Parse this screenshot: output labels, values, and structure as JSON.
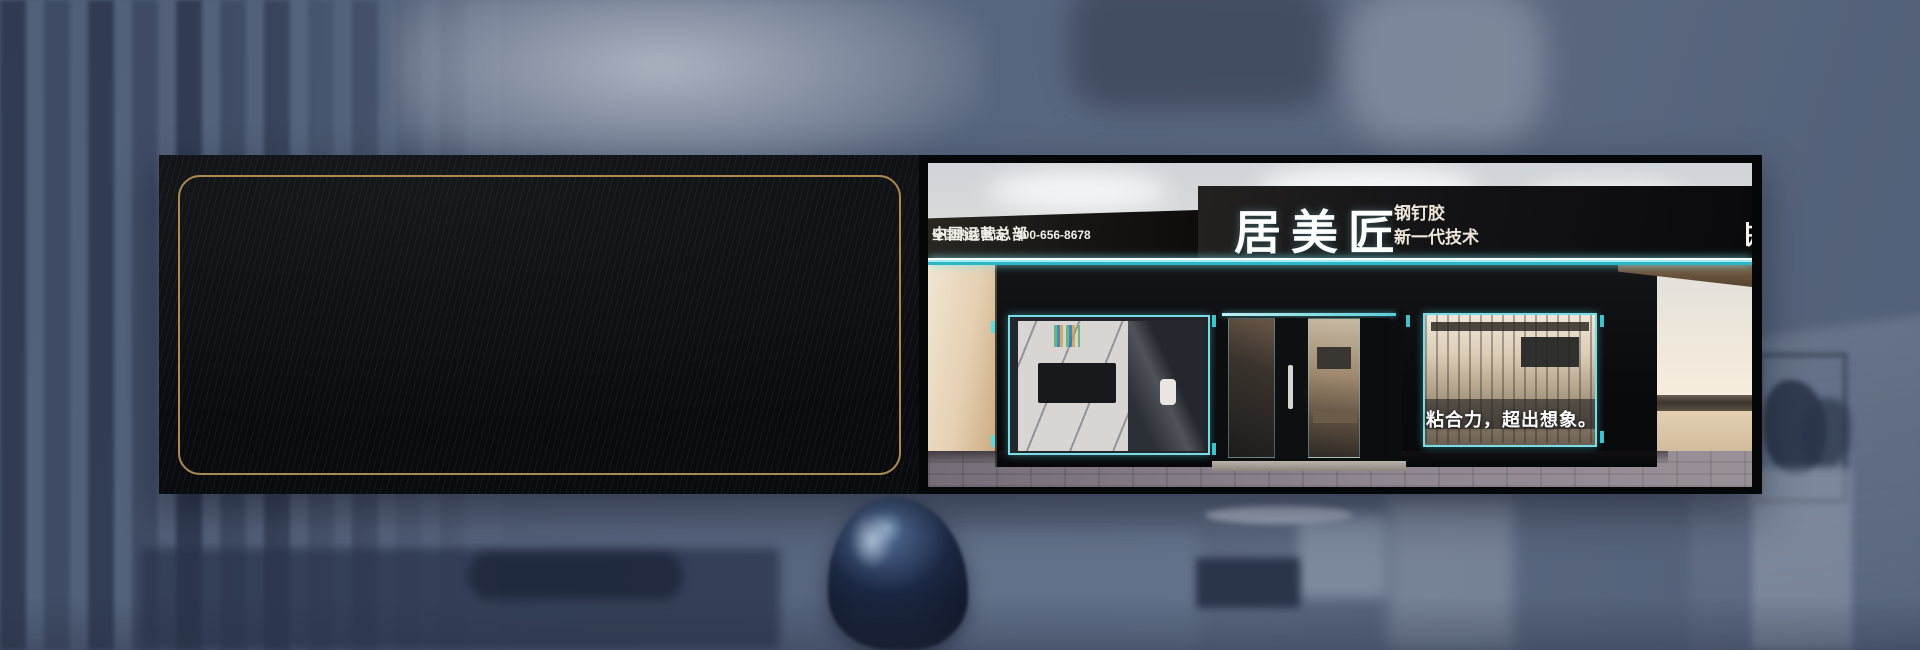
{
  "panel": {
    "features": [
      {
        "title": "粘性强",
        "line1": "不滑移不",
        "line2": "垂坠承重大"
      },
      {
        "title": "适用面广",
        "line1": "无需底涂粘",
        "line2": "接绝大多材料"
      },
      {
        "title": "保护基材",
        "line1": "不腐蚀基材",
        "line2": "不污染基材表面"
      },
      {
        "title": "性能稳定",
        "line1": "耐老化耐候",
        "line2": "优异性能"
      },
      {
        "title": "申缩弹性",
        "line1": "使应热胀冷缩",
        "line2": "与潮湿环境"
      },
      {
        "title": "表面涂饰",
        "line1": "固化后表面可",
        "line2": "重复粘接或打磨"
      }
    ]
  },
  "storefront": {
    "hq_title": "中国运营总部",
    "hotline": "全国热线电话：400-656-8678",
    "brand": "居美匠",
    "product": "钢钉胶",
    "tagline": "新一代技术",
    "right_slogan": "开启环保之美",
    "window_slogan": "粘合力，超出想象。"
  },
  "colors": {
    "accent_gold": "#c9a35f",
    "accent_cyan": "#4fdbe6",
    "billboard_black": "#0a0b0e",
    "background_blue": "#56637c"
  }
}
